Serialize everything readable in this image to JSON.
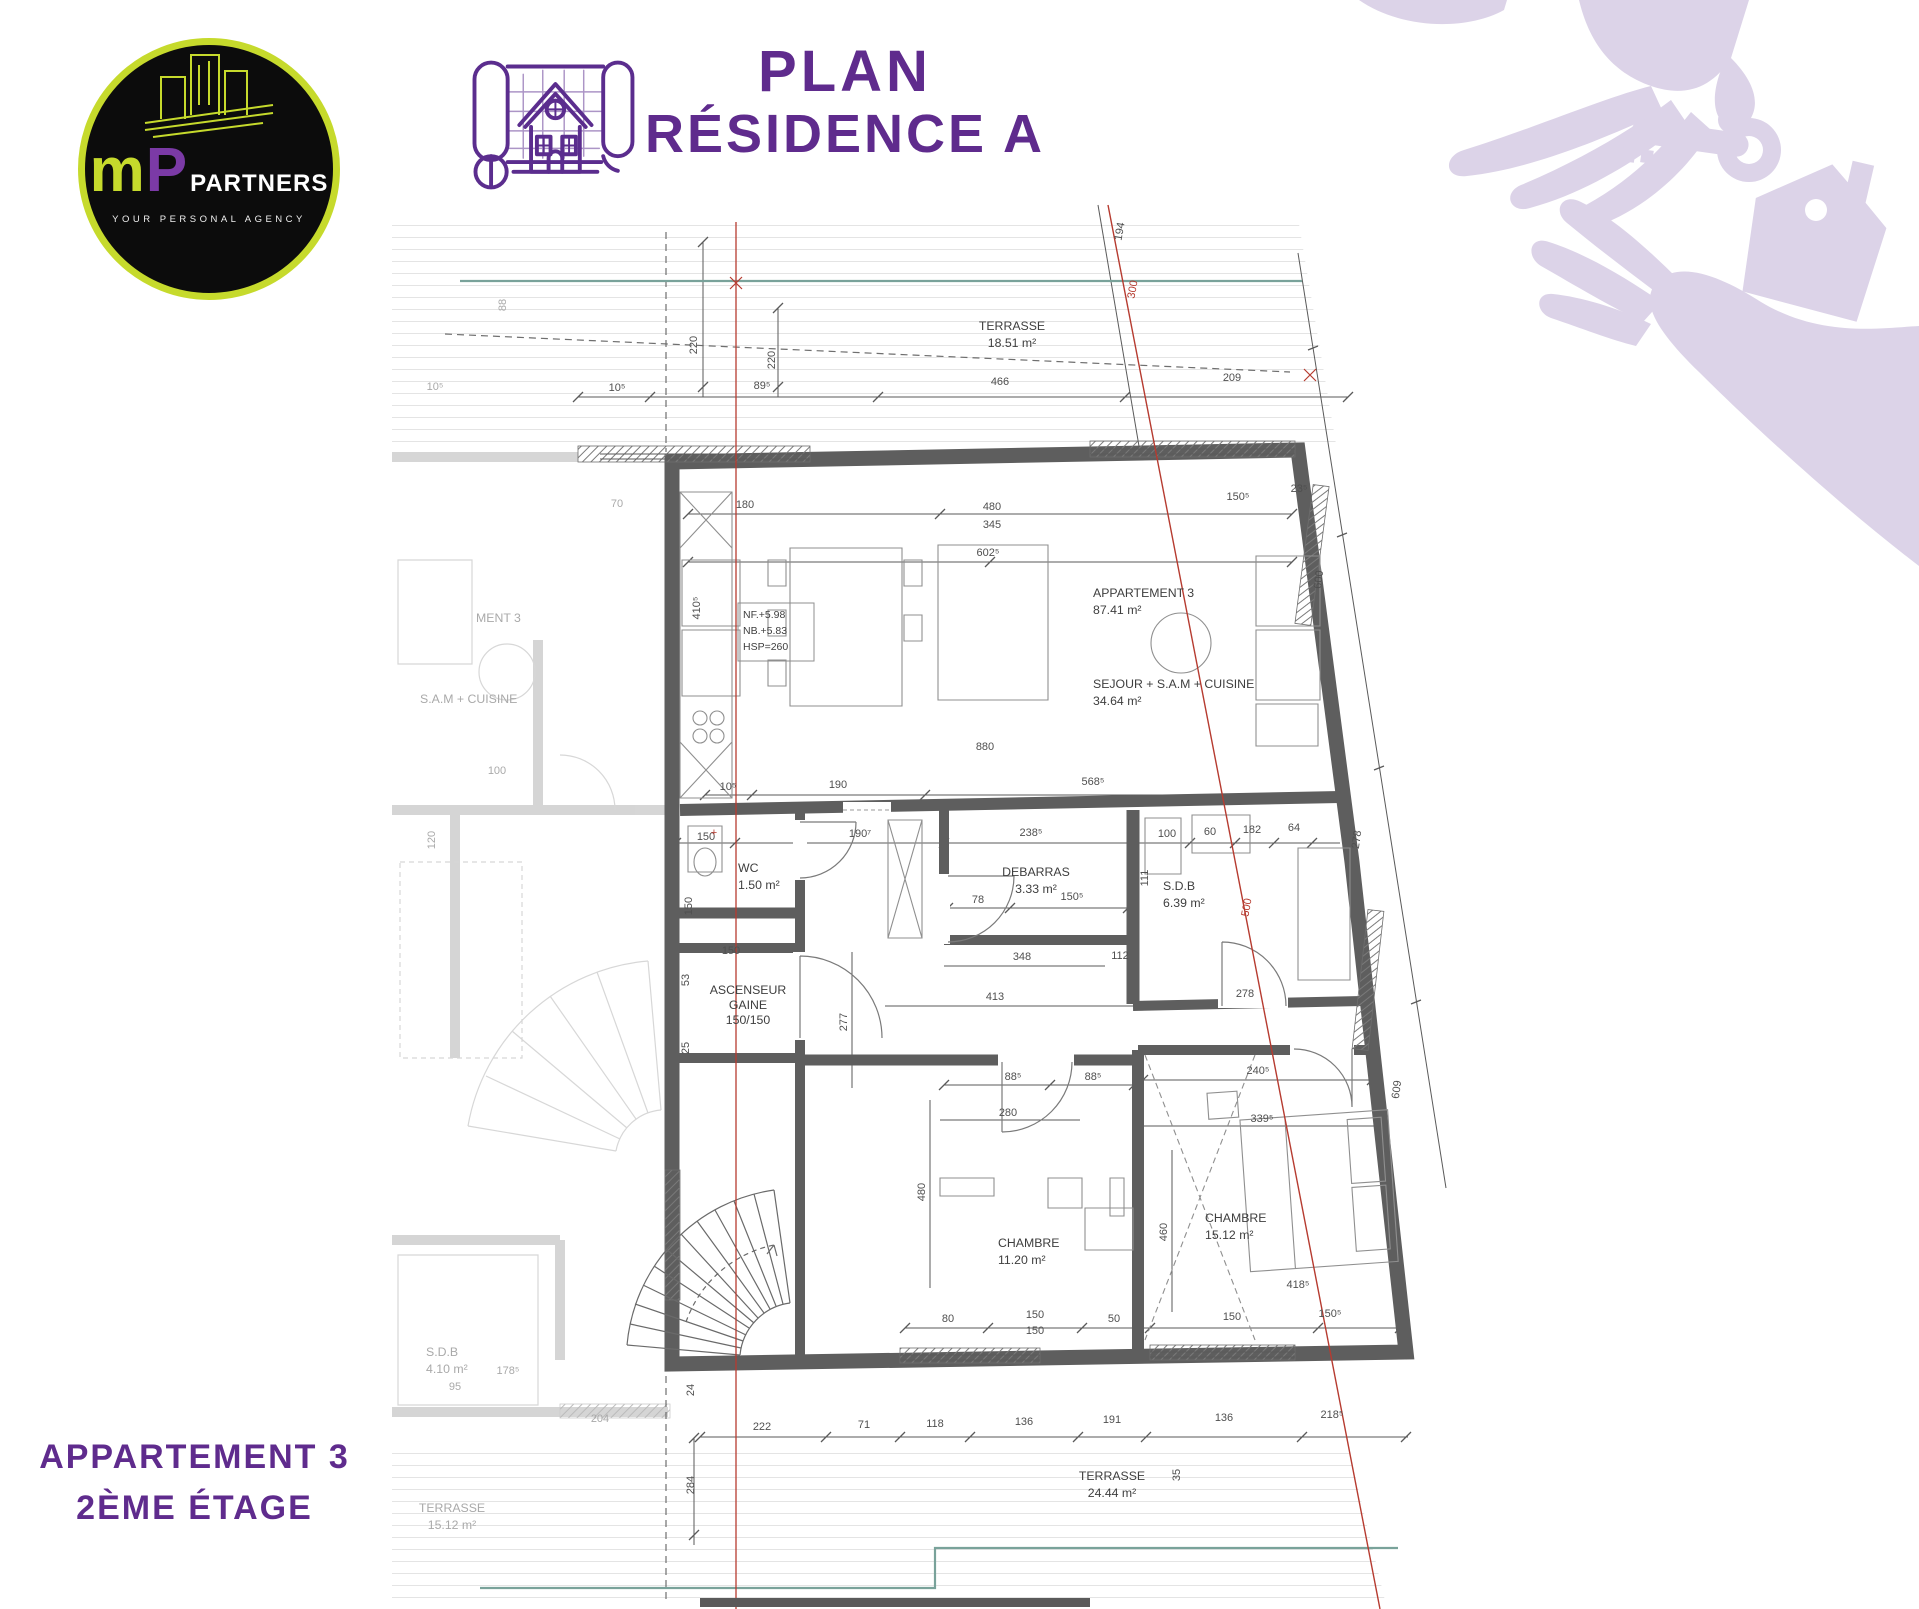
{
  "header": {
    "title_line1": "PLAN",
    "title_line2": "RÉSIDENCE A"
  },
  "logo": {
    "m": "m",
    "p": "P",
    "partners": "PARTNERS",
    "tagline": "YOUR PERSONAL AGENCY"
  },
  "footer": {
    "line1": "APPARTEMENT 3",
    "line2": "2ÈME ÉTAGE"
  },
  "plan": {
    "colors": {
      "wall": "#5e5e5e",
      "dimension_text": "#4f4f4f",
      "axis_red": "#b63b30",
      "boundary_teal": "#79a29a",
      "accent_purple": "#5f2b8d",
      "logo_chartreuse": "#c6da2c",
      "logo_purple": "#7b3aa6",
      "hands_lavender": "#dcd3e8"
    },
    "room_labels": [
      {
        "x": 1012,
        "y": 330,
        "a": "middle",
        "lines": [
          "TERRASSE",
          "18.51 m²"
        ]
      },
      {
        "x": 1093,
        "y": 597,
        "lines": [
          "APPARTEMENT 3",
          "87.41 m²"
        ]
      },
      {
        "x": 1093,
        "y": 688,
        "lines": [
          "SEJOUR + S.A.M + CUISINE",
          "34.64 m²"
        ]
      },
      {
        "x": 738,
        "y": 872,
        "lines": [
          "WC",
          "1.50 m²"
        ]
      },
      {
        "x": 1036,
        "y": 876,
        "a": "middle",
        "lines": [
          "DEBARRAS",
          "3.33 m²"
        ]
      },
      {
        "x": 1163,
        "y": 890,
        "lines": [
          "S.D.B",
          "6.39 m²"
        ]
      },
      {
        "x": 748,
        "y": 994,
        "a": "middle",
        "dy": 15,
        "lines": [
          "ASCENSEUR",
          "GAINE",
          "150/150"
        ]
      },
      {
        "x": 998,
        "y": 1247,
        "lines": [
          "CHAMBRE",
          "11.20 m²"
        ]
      },
      {
        "x": 1205,
        "y": 1222,
        "lines": [
          "CHAMBRE",
          "15.12 m²"
        ]
      },
      {
        "x": 1112,
        "y": 1480,
        "a": "middle",
        "lines": [
          "TERRASSE",
          "24.44 m²"
        ]
      },
      {
        "x": 743,
        "y": 618,
        "cls": "tiny",
        "dy": 16,
        "lines": [
          "NF.+5.98",
          "NB.+5.83",
          "HSP=260"
        ]
      },
      {
        "x": 476,
        "y": 622,
        "cls": "ghost",
        "lines": [
          "MENT 3"
        ]
      },
      {
        "x": 420,
        "y": 703,
        "cls": "ghost",
        "lines": [
          "S.A.M + CUISINE"
        ]
      },
      {
        "x": 426,
        "y": 1356,
        "cls": "ghost",
        "lines": [
          "S.D.B",
          "4.10 m²"
        ]
      },
      {
        "x": 452,
        "y": 1512,
        "a": "middle",
        "cls": "ghost",
        "lines": [
          "TERRASSE",
          "15.12 m²"
        ]
      }
    ],
    "dim_labels": [
      {
        "t": "10⁵",
        "x": 617,
        "y": 391
      },
      {
        "t": "89⁵",
        "x": 762,
        "y": 389
      },
      {
        "t": "466",
        "x": 1000,
        "y": 385
      },
      {
        "t": "209",
        "x": 1232,
        "y": 381
      },
      {
        "t": "220",
        "x": 697,
        "y": 345,
        "r": -90
      },
      {
        "t": "220",
        "x": 775,
        "y": 360,
        "r": -90
      },
      {
        "t": "194",
        "x": 1123,
        "y": 232,
        "r": -80
      },
      {
        "t": "300",
        "x": 1136,
        "y": 290,
        "r": -80,
        "c": "red"
      },
      {
        "t": "88",
        "x": 506,
        "y": 305,
        "r": -90,
        "c": "ghost"
      },
      {
        "t": "10⁵",
        "x": 435,
        "y": 390,
        "c": "ghost"
      },
      {
        "t": "180",
        "x": 745,
        "y": 508
      },
      {
        "t": "480",
        "x": 992,
        "y": 510
      },
      {
        "t": "345",
        "x": 992,
        "y": 528
      },
      {
        "t": "602⁵",
        "x": 988,
        "y": 556
      },
      {
        "t": "150⁵",
        "x": 1238,
        "y": 500
      },
      {
        "t": "23⁵",
        "x": 1299,
        "y": 492
      },
      {
        "t": "410⁵",
        "x": 700,
        "y": 608,
        "r": -90
      },
      {
        "t": "70",
        "x": 617,
        "y": 507,
        "c": "ghost"
      },
      {
        "t": "880",
        "x": 985,
        "y": 750
      },
      {
        "t": "10⁵",
        "x": 728,
        "y": 790
      },
      {
        "t": "190",
        "x": 838,
        "y": 788
      },
      {
        "t": "568⁵",
        "x": 1093,
        "y": 785
      },
      {
        "t": "150",
        "x": 706,
        "y": 840
      },
      {
        "t": "190⁷",
        "x": 860,
        "y": 837
      },
      {
        "t": "238⁵",
        "x": 1031,
        "y": 836
      },
      {
        "t": "100",
        "x": 1167,
        "y": 837
      },
      {
        "t": "60",
        "x": 1210,
        "y": 835
      },
      {
        "t": "182",
        "x": 1252,
        "y": 833
      },
      {
        "t": "64",
        "x": 1294,
        "y": 831
      },
      {
        "t": "78",
        "x": 978,
        "y": 903
      },
      {
        "t": "150⁵",
        "x": 1072,
        "y": 900
      },
      {
        "t": "111",
        "x": 1148,
        "y": 878,
        "r": -90
      },
      {
        "t": "348",
        "x": 1022,
        "y": 960
      },
      {
        "t": "413",
        "x": 995,
        "y": 1000
      },
      {
        "t": "112",
        "x": 1120,
        "y": 959
      },
      {
        "t": "278",
        "x": 1245,
        "y": 997
      },
      {
        "t": "150",
        "x": 731,
        "y": 954
      },
      {
        "t": "53",
        "x": 689,
        "y": 980,
        "r": -90
      },
      {
        "t": "25",
        "x": 689,
        "y": 1048,
        "r": -90
      },
      {
        "t": "150",
        "x": 692,
        "y": 906,
        "r": -90
      },
      {
        "t": "277",
        "x": 847,
        "y": 1022,
        "r": -90
      },
      {
        "t": "88⁵",
        "x": 1013,
        "y": 1080
      },
      {
        "t": "88⁵",
        "x": 1093,
        "y": 1080
      },
      {
        "t": "240⁵",
        "x": 1258,
        "y": 1074
      },
      {
        "t": "280",
        "x": 1008,
        "y": 1116
      },
      {
        "t": "339⁵",
        "x": 1262,
        "y": 1122
      },
      {
        "t": "480",
        "x": 925,
        "y": 1192,
        "r": -90
      },
      {
        "t": "460",
        "x": 1167,
        "y": 1232,
        "r": -90
      },
      {
        "t": "418⁵",
        "x": 1298,
        "y": 1288
      },
      {
        "t": "80",
        "x": 948,
        "y": 1322
      },
      {
        "t": "150",
        "x": 1035,
        "y": 1318
      },
      {
        "t": "150",
        "x": 1035,
        "y": 1334
      },
      {
        "t": "50",
        "x": 1114,
        "y": 1322
      },
      {
        "t": "150",
        "x": 1232,
        "y": 1320
      },
      {
        "t": "150⁵",
        "x": 1330,
        "y": 1317
      },
      {
        "t": "222",
        "x": 762,
        "y": 1430
      },
      {
        "t": "71",
        "x": 864,
        "y": 1428
      },
      {
        "t": "118",
        "x": 935,
        "y": 1427
      },
      {
        "t": "136",
        "x": 1024,
        "y": 1425
      },
      {
        "t": "191",
        "x": 1112,
        "y": 1423
      },
      {
        "t": "136",
        "x": 1224,
        "y": 1421
      },
      {
        "t": "218⁵",
        "x": 1332,
        "y": 1418
      },
      {
        "t": "284",
        "x": 694,
        "y": 1485,
        "r": -90
      },
      {
        "t": "24",
        "x": 694,
        "y": 1390,
        "r": -90
      },
      {
        "t": "204",
        "x": 600,
        "y": 1422,
        "c": "ghost"
      },
      {
        "t": "35",
        "x": 1180,
        "y": 1475,
        "r": -90
      },
      {
        "t": "95",
        "x": 455,
        "y": 1390,
        "c": "ghost"
      },
      {
        "t": "178⁵",
        "x": 508,
        "y": 1374,
        "c": "ghost"
      },
      {
        "t": "120",
        "x": 435,
        "y": 840,
        "r": -90,
        "c": "ghost"
      },
      {
        "t": "100",
        "x": 497,
        "y": 774,
        "c": "ghost"
      },
      {
        "t": "600",
        "x": 1322,
        "y": 580,
        "r": -82
      },
      {
        "t": "278",
        "x": 1360,
        "y": 840,
        "r": -82
      },
      {
        "t": "609",
        "x": 1400,
        "y": 1090,
        "r": -82
      },
      {
        "t": "500",
        "x": 1250,
        "y": 908,
        "r": -80,
        "c": "red"
      },
      {
        "t": "+",
        "x": 714,
        "y": 836,
        "c": "red"
      }
    ]
  }
}
